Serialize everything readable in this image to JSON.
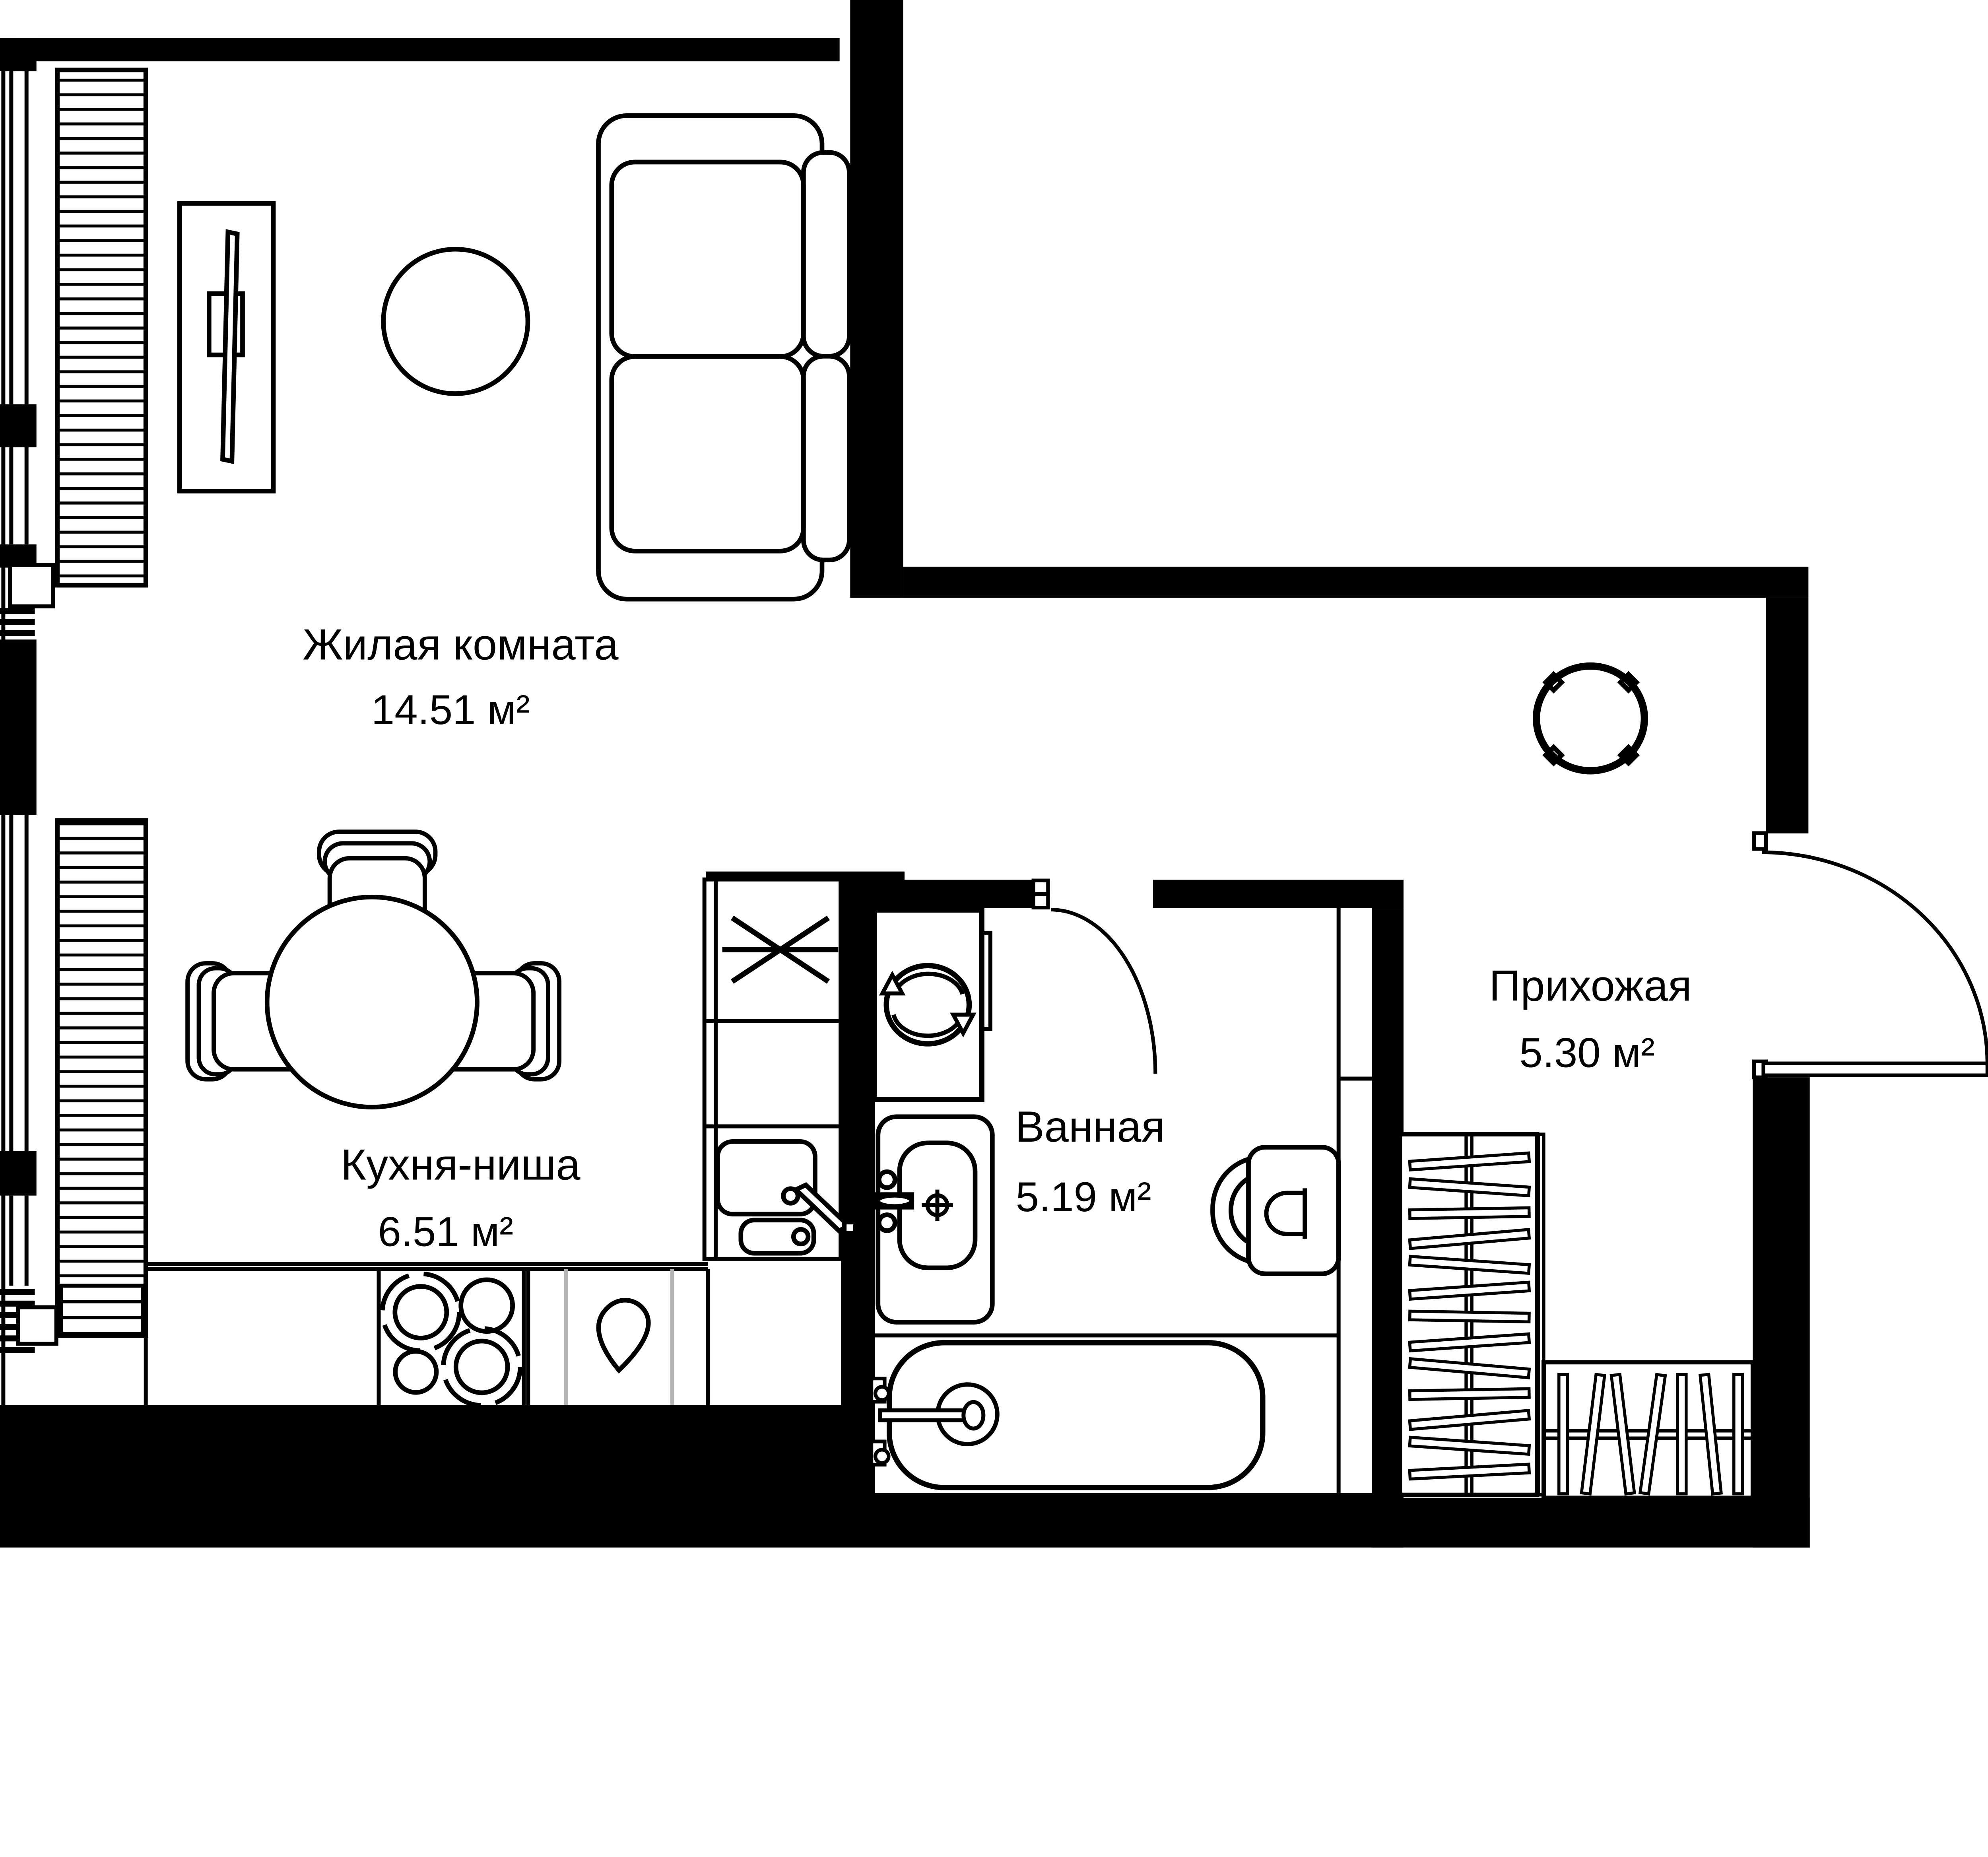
{
  "plan": {
    "title": "apartment-floor-plan",
    "rooms": [
      {
        "name": "Жилая комната",
        "area": "14.51 м²"
      },
      {
        "name": "Кухня-ниша",
        "area": "6.51 м²"
      },
      {
        "name": "Ванная",
        "area": "5.19 м²"
      },
      {
        "name": "Прихожая",
        "area": "5.30 м²"
      }
    ],
    "colors": {
      "walls": "#000000",
      "background": "#ffffff",
      "divider_gray": "#b3b3b3"
    }
  }
}
